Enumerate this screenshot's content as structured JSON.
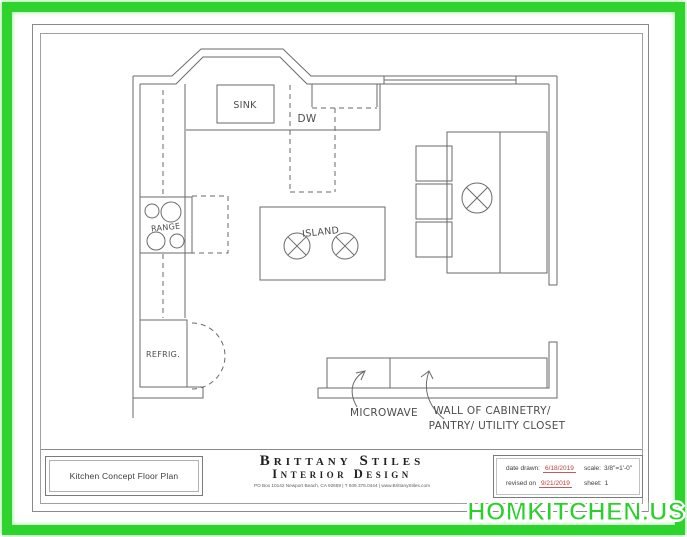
{
  "plan": {
    "labels": {
      "sink": "SINK",
      "dw": "DW",
      "range": "RANGE",
      "island": "ISLAND",
      "refrig": "REFRIG.",
      "microwave": "MICROWAVE",
      "wall_cabinetry_line1": "WALL OF CABINETRY/",
      "wall_cabinetry_line2": "PANTRY/ UTILITY CLOSET"
    }
  },
  "title_block": {
    "drawing_title": "Kitchen Concept Floor Plan",
    "firm_name": "Brittany Stiles",
    "firm_subtitle": "Interior Design",
    "firm_contact": "PO Box 10142 Newport Beach, CA 92659 | T 949.375.0444 | www.BrittanyStiles.com",
    "date_drawn_label": "date drawn:",
    "date_drawn_value": "6/18/2019",
    "scale_label": "scale:",
    "scale_value": "3/8\"=1'-0\"",
    "revised_label": "revised on",
    "revised_value": "9/21/2019",
    "sheet_label": "sheet:",
    "sheet_value": "1"
  },
  "watermark": {
    "text": "HOMKITCHEN.US"
  },
  "colors": {
    "frame_green": "#2ed32e",
    "watermark_green": "#2bcf2b",
    "date_red": "#c23b3b",
    "line_gray": "#6a6a6a"
  }
}
